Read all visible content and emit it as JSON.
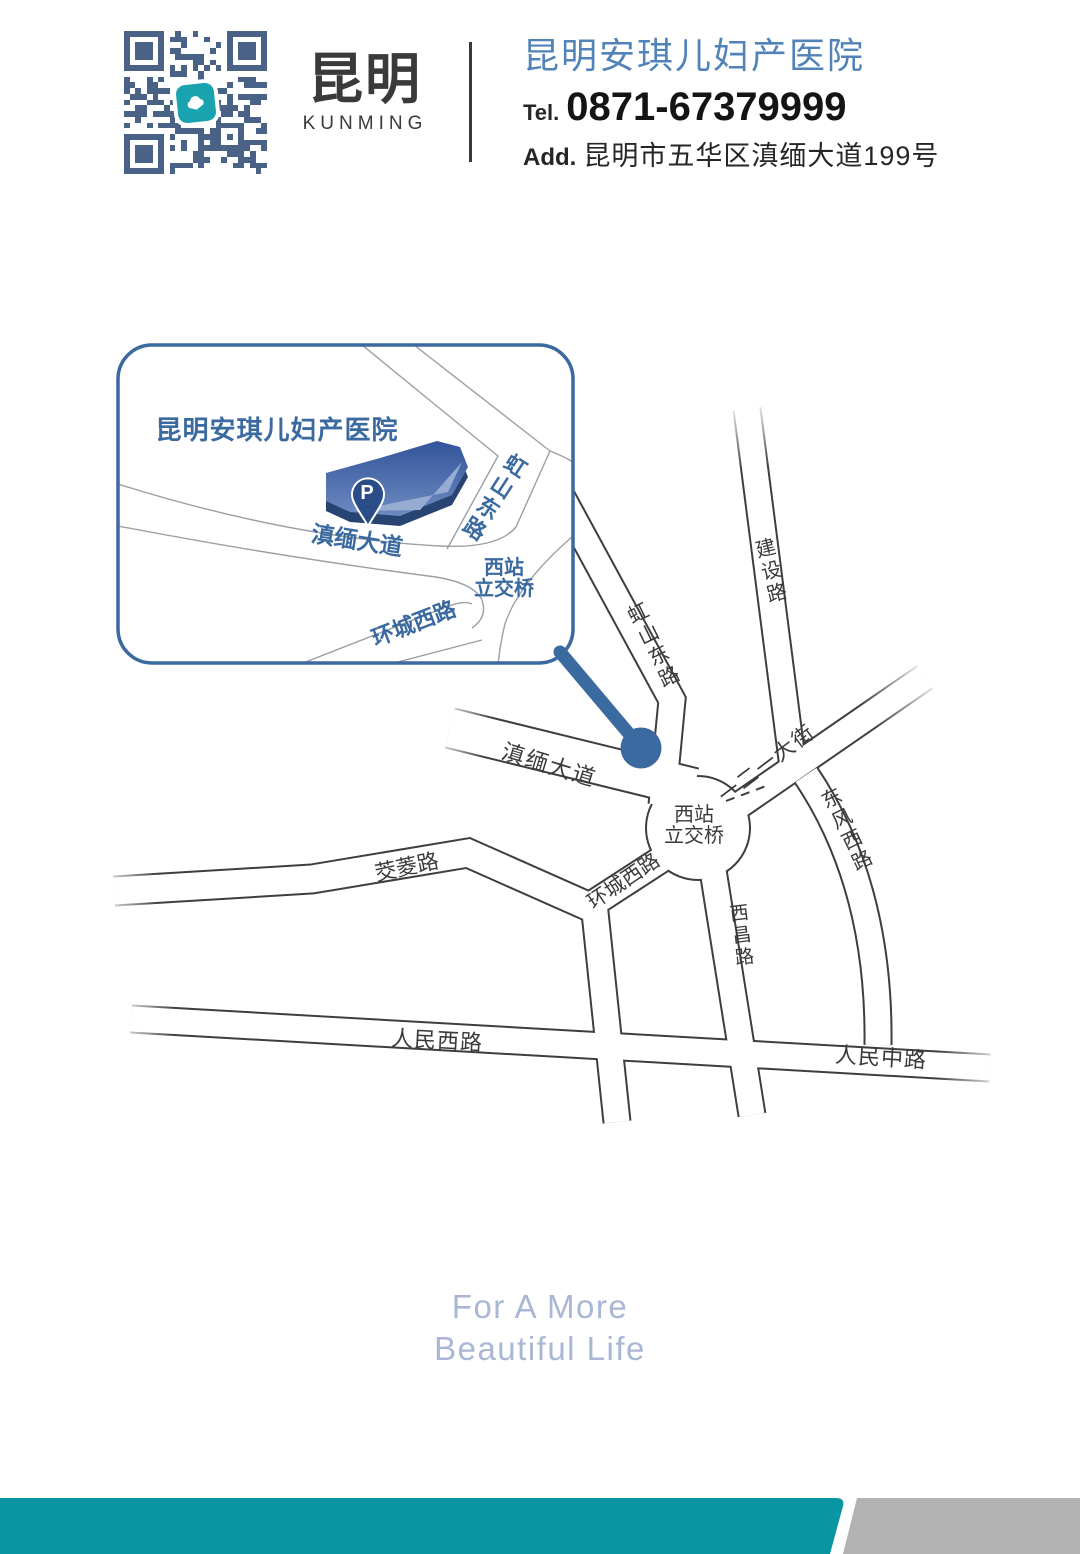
{
  "header": {
    "city_cn": "昆明",
    "city_en": "KUNMING",
    "hospital_name": "昆明安琪儿妇产医院",
    "tel_label": "Tel.",
    "tel_number": "0871-67379999",
    "addr_label": "Add.",
    "addr_text": "昆明市五华区滇缅大道199号"
  },
  "inset": {
    "title": "昆明安琪儿妇产医院",
    "parking": "P",
    "road_dianmian": "滇缅大道",
    "road_hongshan": "虹山东路",
    "road_huancheng": "环城西路",
    "junction_line1": "西站",
    "junction_line2": "立交桥"
  },
  "map": {
    "road_jianshe": "建设路",
    "road_hongshan": "虹山东路",
    "road_dianmian": "滇缅大道",
    "road_yieryi": "一二一大街",
    "road_dongfeng": "东风西路",
    "road_huancheng": "环城西路",
    "road_xichang": "西昌路",
    "road_jiaoling": "茭菱路",
    "road_renmin_west": "人民西路",
    "road_renmin_mid": "人民中路",
    "junction_line1": "西站",
    "junction_line2": "立交桥"
  },
  "slogan": {
    "line1": "For A More",
    "line2": "Beautiful Life"
  },
  "colors": {
    "qr": "#4a6285",
    "teal": "#19a3ae",
    "blue": "#3b6aa0",
    "name-blue": "#5183b8",
    "road": "#3e3e3e",
    "label-dark": "#3a3a3a",
    "slogan-blue": "#a9b7d5",
    "footer-teal": "#0a95a3",
    "footer-gray": "#b2b2b2",
    "ink": "#2b2b2b"
  }
}
